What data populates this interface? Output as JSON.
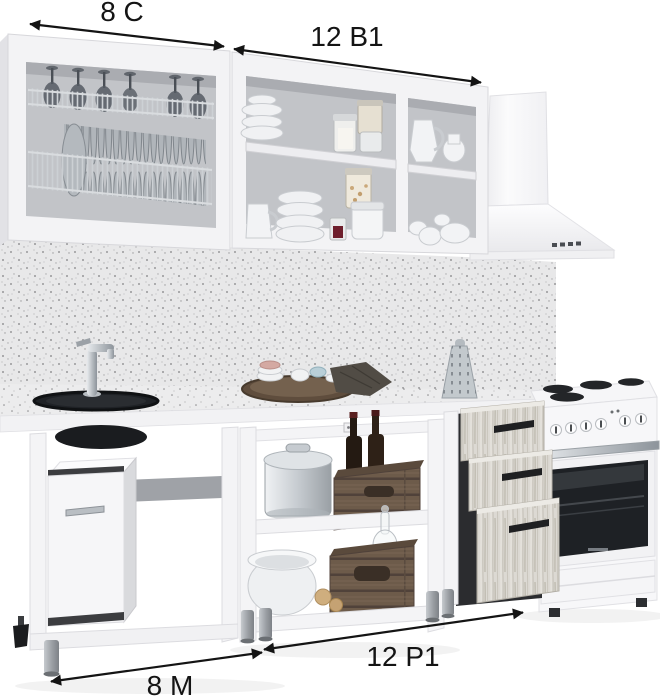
{
  "annotations": {
    "top_left": {
      "label": "8 С"
    },
    "top_middle": {
      "label": "12 В1"
    },
    "bottom_middle": {
      "label": "12 Р1"
    },
    "bottom_left": {
      "label": "8 М"
    }
  },
  "colors": {
    "background": "#ffffff",
    "annotation_ink": "#141414",
    "cabinet_white": "#f3f3f5",
    "cabinet_interior_gray": "#c2c4c8",
    "speckled_worktop": "#e8e8e9",
    "plate_metal_gray": "#b0b5ba",
    "wood_crate": "#6d5b4a",
    "drawer_wood": "#dcd9d3",
    "oven_glass": "#1e2125",
    "chrome_metal": "#b9bec3",
    "sink_black": "#1f2226"
  },
  "modules": {
    "top_left": "wall-cabinet-dish-drainer",
    "top_middle": "wall-cabinet-open-shelves",
    "top_right": "chimney-range-hood",
    "bottom_left": "sink-base-unit",
    "bottom_middle": "open-shelf-base-unit",
    "bottom_right_drawers": "three-drawer-unit",
    "bottom_right": "freestanding-cooker"
  }
}
